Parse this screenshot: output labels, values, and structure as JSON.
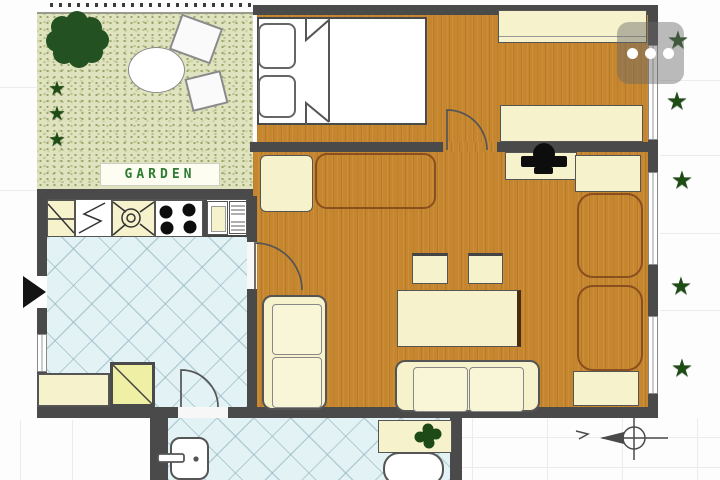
{
  "labels": {
    "garden": "GARDEN"
  },
  "menu": {
    "icon": "three-dots-horizontal",
    "dot_count": 3
  },
  "glyphs": {
    "star": "★"
  },
  "stars": {
    "left": [
      {
        "x": 57,
        "y": 89,
        "s": 20
      },
      {
        "x": 57,
        "y": 114,
        "s": 20
      },
      {
        "x": 57,
        "y": 140,
        "s": 20
      }
    ],
    "right": [
      {
        "x": 678,
        "y": 41,
        "s": 25
      },
      {
        "x": 677,
        "y": 102,
        "s": 25
      },
      {
        "x": 682,
        "y": 181,
        "s": 25
      },
      {
        "x": 681,
        "y": 287,
        "s": 25
      },
      {
        "x": 682,
        "y": 369,
        "s": 25
      }
    ]
  },
  "kitchen": {
    "burner_count": 4,
    "fixtures": [
      "dishwasher-unit",
      "prep-unit",
      "sink-unit",
      "stove-4-burner",
      "fridge-unit",
      "radiator-unit"
    ]
  },
  "colors": {
    "wall": "#4a4a4a",
    "wood": "#c6862e",
    "cream": "#f6f2cc",
    "bed_white": "#ffffff",
    "tile": "#e3f2f5",
    "garden_bg": "#e0e3bf",
    "green": "#1d4c15",
    "garden_text": "#2e7d32",
    "shower": "#eff0a6",
    "mat_border": "#8a4f1f",
    "overlay": "rgba(105,105,105,0.45)"
  }
}
